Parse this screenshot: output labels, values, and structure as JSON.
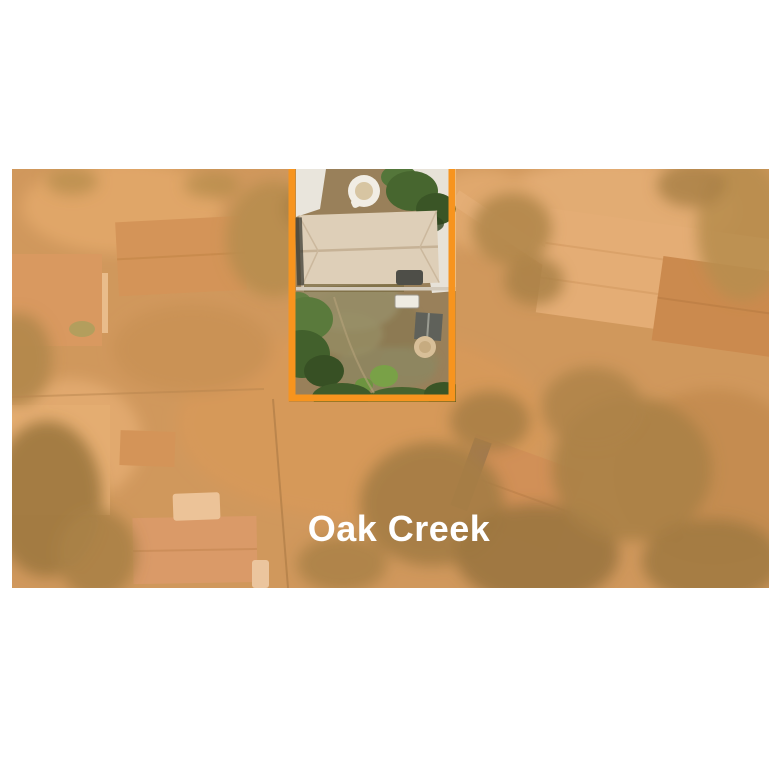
{
  "page": {
    "background_color": "#ffffff"
  },
  "photo": {
    "tint_color": "#ea9440",
    "wash_color": "#ffffff"
  },
  "parcel": {
    "border_color": "#f7941e"
  },
  "label": {
    "text": "Oak Creek",
    "color": "#ffffff"
  }
}
